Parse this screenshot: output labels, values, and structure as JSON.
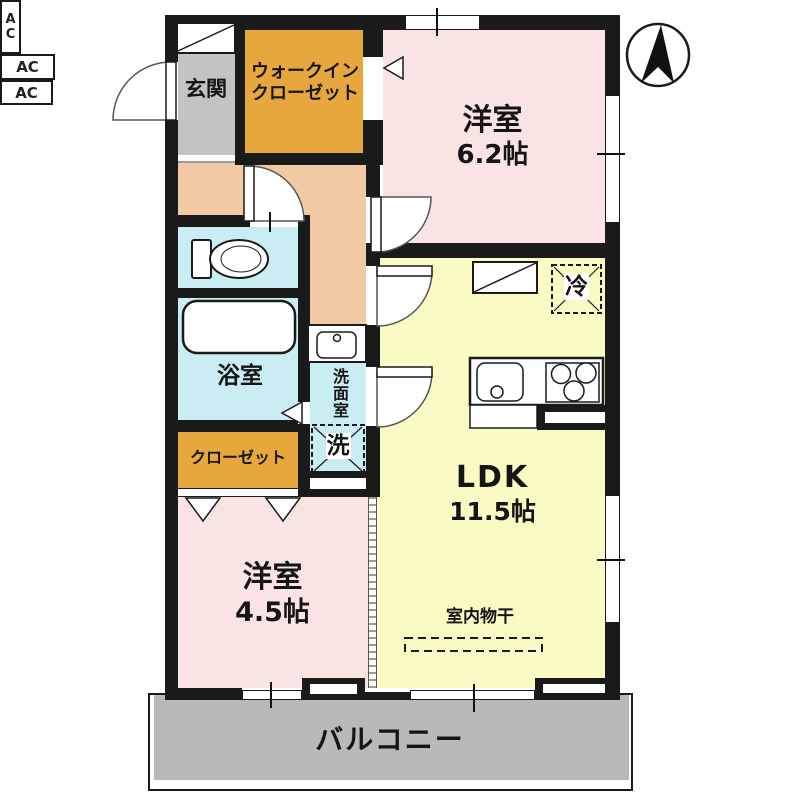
{
  "plan_title": "2LDK floor plan",
  "rooms": {
    "entrance": "玄関",
    "wic_line1": "ウォークイン",
    "wic_line2": "クローゼット",
    "bedroom1": "洋室",
    "bedroom1_size": "6.2帖",
    "bath": "浴室",
    "washroom": "洗面室",
    "closet": "クローゼット",
    "ldk": "LDK",
    "ldk_size": "11.5帖",
    "bedroom2": "洋室",
    "bedroom2_size": "4.5帖",
    "balcony": "バルコニー"
  },
  "fixtures": {
    "washer": "洗",
    "fridge": "冷",
    "indoor_drying": "室内物干",
    "ac": "AC"
  },
  "icons": {
    "compass": "north-arrow",
    "toilet": "toilet",
    "bathtub": "bathtub",
    "sink": "washbasin",
    "kitchen": "sink-and-stove"
  },
  "colors": {
    "wall": "#1a1a1a",
    "pink": "#f9e3e3",
    "yellow": "#fafac5",
    "orange": "#e8a73c",
    "peach": "#f1c9a5",
    "cyan": "#c9edf2",
    "gray_entrance": "#c3c3c3",
    "gray_balcony": "#b9b9b9"
  }
}
